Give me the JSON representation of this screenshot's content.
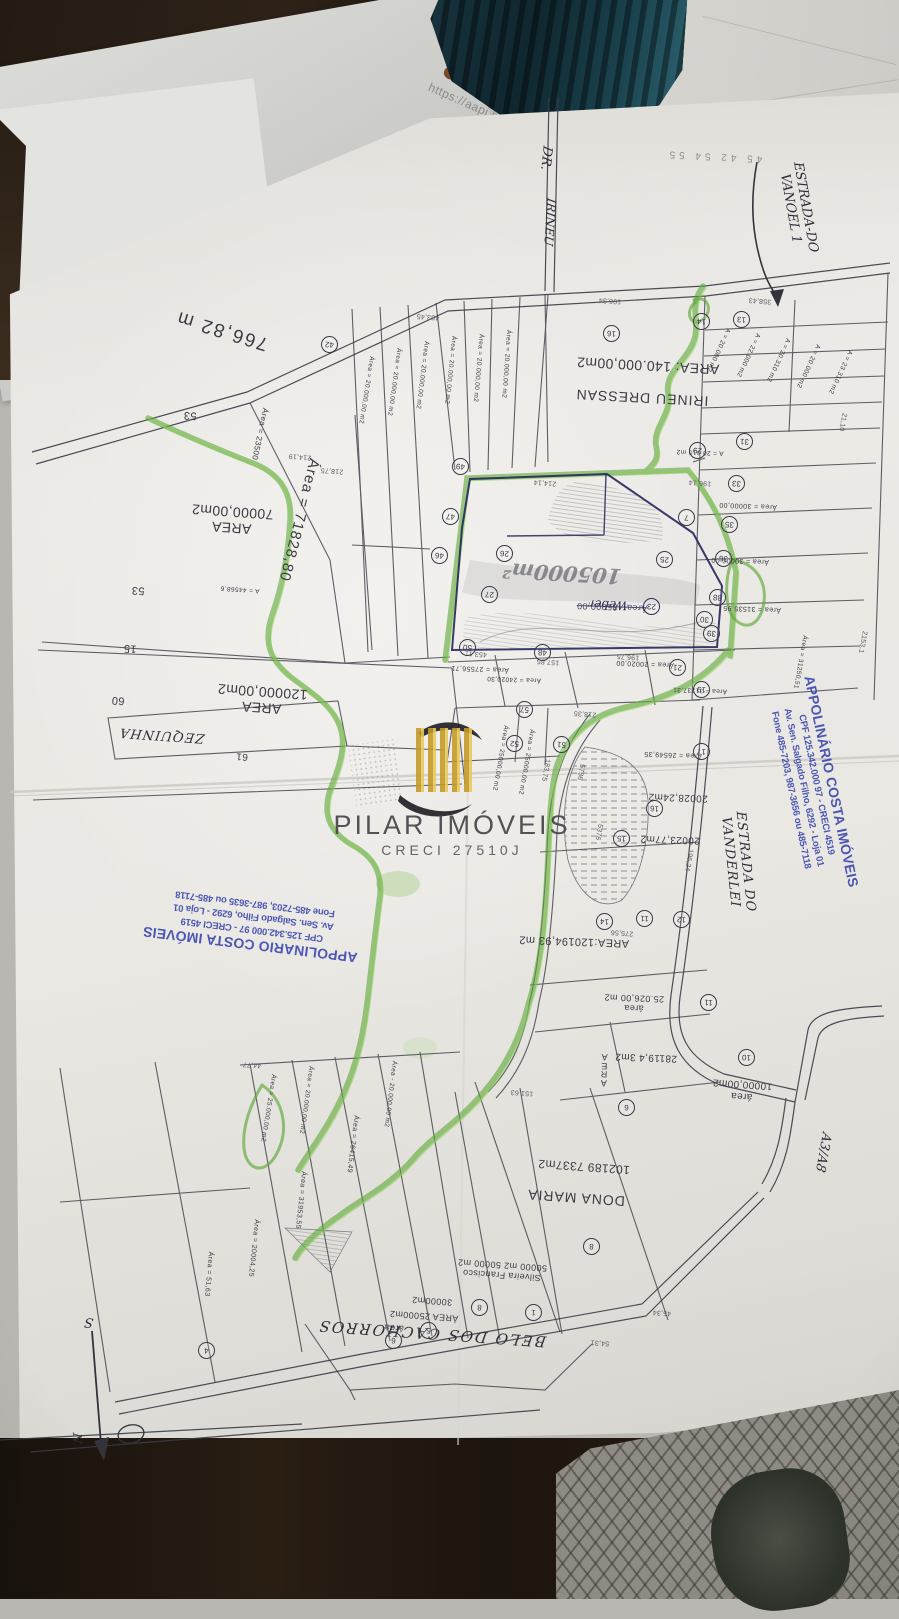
{
  "background": {
    "url_text": "https://aapj.bb.com"
  },
  "watermark": {
    "title": "PILAR IMÓVEIS",
    "creci": "CRECI 27510J"
  },
  "stamp_right": {
    "lines": [
      "APPOLINÁRIO COSTA IMÓVEIS",
      "CPF 125.342.000 97  -  CRECI 4519",
      "Av. Sen. Salgado Filho, 6292 - Loja 01",
      "Fone 485-7203, 987-3656 ou 485-7118"
    ]
  },
  "stamp_left": {
    "lines": [
      "APPOLINARIO COSTA IMÓVEIS",
      "CPF 125.342.000 97  -  CRECI 4519",
      "Av. Sen. Salgado Filho, 6292 - Loja 01",
      "Fone 485-7203, 987-3635 ou 485-7118"
    ]
  },
  "map_labels": [
    {
      "t": "766,82 m",
      "x": 222,
      "y": 330,
      "r": 197,
      "s": 19,
      "ls": 2
    },
    {
      "t": "Área = 71828,80",
      "x": 299,
      "y": 520,
      "r": 104,
      "s": 15,
      "ls": 1
    },
    {
      "t": "Área = 23500",
      "x": 260,
      "y": 434,
      "r": 102,
      "s": 8
    },
    {
      "lines": [
        "AREA",
        "70000,00m2"
      ],
      "x": 232,
      "y": 520,
      "r": 184,
      "s": 14
    },
    {
      "lines": [
        "AREA",
        "120000,00m2"
      ],
      "x": 262,
      "y": 700,
      "r": 184,
      "s": 14
    },
    {
      "t": "AREA: 140.000,00m2",
      "x": 648,
      "y": 366,
      "r": 183,
      "s": 14
    },
    {
      "t": "IRINEU DRESSAN",
      "x": 642,
      "y": 398,
      "r": 183,
      "s": 14,
      "ls": 1
    },
    {
      "t": "AREA:120194,93 m2",
      "x": 574,
      "y": 941,
      "r": 182,
      "s": 11
    },
    {
      "t": "Área = 26549,35",
      "x": 673,
      "y": 754,
      "r": 182,
      "s": 7
    },
    {
      "t": "20028,24m2",
      "x": 678,
      "y": 797,
      "r": 182,
      "s": 10
    },
    {
      "t": "20023,77m2",
      "x": 670,
      "y": 839,
      "r": 182,
      "s": 10
    },
    {
      "lines": [
        "área",
        "25.026,00 m2"
      ],
      "x": 634,
      "y": 1003,
      "r": 182,
      "s": 9
    },
    {
      "t": "28119,4 3m2",
      "x": 646,
      "y": 1057,
      "r": 182,
      "s": 10
    },
    {
      "lines": [
        "A",
        "R",
        "E",
        "A"
      ],
      "x": 604,
      "y": 1070,
      "r": 182,
      "s": 9,
      "cls": "tight"
    },
    {
      "t": "102189 7337m2",
      "x": 584,
      "y": 1166,
      "r": 184,
      "s": 12
    },
    {
      "t": "DONA MARIA",
      "x": 576,
      "y": 1198,
      "r": 184,
      "s": 14,
      "ls": 1
    },
    {
      "lines": [
        "Silveira Francisco",
        "50000 m2  50000 m2"
      ],
      "x": 502,
      "y": 1270,
      "r": 184,
      "s": 9
    },
    {
      "t": "30000m2",
      "x": 432,
      "y": 1301,
      "r": 184,
      "s": 9
    },
    {
      "t": "ÁREA 25000m2",
      "x": 424,
      "y": 1316,
      "r": 184,
      "s": 9
    },
    {
      "t": "área",
      "x": 394,
      "y": 1328,
      "r": 184,
      "s": 9
    },
    {
      "lines": [
        "área",
        "10000,00m2"
      ],
      "x": 742,
      "y": 1090,
      "r": 184,
      "s": 10
    },
    {
      "t": "Área = 20.000,00 m2",
      "x": 366,
      "y": 390,
      "r": 99,
      "s": 6.5
    },
    {
      "t": "Área = 20.000,00 m2",
      "x": 394,
      "y": 382,
      "r": 98,
      "s": 6.5
    },
    {
      "t": "Área = 20.000,00 m2",
      "x": 422,
      "y": 375,
      "r": 97,
      "s": 6.5
    },
    {
      "t": "Área = 20.000,00 m2",
      "x": 450,
      "y": 370,
      "r": 96,
      "s": 6.5
    },
    {
      "t": "Área = 20.000,00 m2",
      "x": 478,
      "y": 368,
      "r": 95,
      "s": 6.5
    },
    {
      "t": "Área = 20.000,00 m2",
      "x": 506,
      "y": 364,
      "r": 94,
      "s": 6.5
    },
    {
      "t": "A = 20.000 m2",
      "x": 718,
      "y": 350,
      "r": 115,
      "s": 6.5
    },
    {
      "t": "A = 22.000 m2",
      "x": 748,
      "y": 355,
      "r": 115,
      "s": 6.5
    },
    {
      "t": "A = 20.310 m2",
      "x": 778,
      "y": 360,
      "r": 115,
      "s": 6.5
    },
    {
      "t": "A = 20.000 m2",
      "x": 808,
      "y": 366,
      "r": 115,
      "s": 6.5
    },
    {
      "t": "A = 23.310 m2",
      "x": 840,
      "y": 372,
      "r": 115,
      "s": 6.5
    },
    {
      "t": "A = 20.010 m2",
      "x": 700,
      "y": 452,
      "r": 182,
      "s": 6.5
    },
    {
      "t": "Área = 30000,00",
      "x": 748,
      "y": 505,
      "r": 182,
      "s": 7
    },
    {
      "t": "Área = 30000,00",
      "x": 740,
      "y": 560,
      "r": 182,
      "s": 7
    },
    {
      "t": "Área = 31535,95",
      "x": 752,
      "y": 608,
      "r": 182,
      "s": 7
    },
    {
      "t": "Área = 31237,31",
      "x": 700,
      "y": 690,
      "r": 182,
      "s": 6.5
    },
    {
      "t": "Área = 31250,51",
      "x": 800,
      "y": 662,
      "r": 100,
      "s": 6.5
    },
    {
      "t": "Área - 85000,00",
      "x": 612,
      "y": 607,
      "r": 182,
      "s": 9,
      "cls": "strike",
      "c": "#4a4a6a"
    },
    {
      "t": "Área = 27556,71",
      "x": 480,
      "y": 668,
      "r": 182,
      "s": 7
    },
    {
      "t": "Área = 20020,00",
      "x": 645,
      "y": 663,
      "r": 182,
      "s": 7
    },
    {
      "t": "Área = 24020,30",
      "x": 514,
      "y": 679,
      "r": 182,
      "s": 6.5
    },
    {
      "t": "Área = 25000,00 m2",
      "x": 500,
      "y": 758,
      "r": 100,
      "s": 6.5
    },
    {
      "t": "Área = 25000,00 m2",
      "x": 526,
      "y": 762,
      "r": 100,
      "s": 6.5
    },
    {
      "t": "A = 44568,6",
      "x": 240,
      "y": 589,
      "r": 184,
      "s": 6.5
    },
    {
      "t": "Área = 25.000,00 m2",
      "x": 268,
      "y": 1108,
      "r": 99,
      "s": 6.5
    },
    {
      "t": "Área = 20.000,00 m2",
      "x": 306,
      "y": 1100,
      "r": 98,
      "s": 6.5
    },
    {
      "t": "Área = 26415,49",
      "x": 352,
      "y": 1144,
      "r": 97,
      "s": 7
    },
    {
      "t": "Área = 31953,55",
      "x": 300,
      "y": 1200,
      "r": 96,
      "s": 7
    },
    {
      "t": "Área = 20004,25",
      "x": 253,
      "y": 1248,
      "r": 96,
      "s": 7
    },
    {
      "t": "Área = 51,63",
      "x": 208,
      "y": 1274,
      "r": 95,
      "s": 7
    },
    {
      "t": "Área - 20.000,00 m2",
      "x": 390,
      "y": 1094,
      "r": 97,
      "s": 6.5
    },
    {
      "t": "60",
      "x": 118,
      "y": 700,
      "r": 184,
      "s": 11
    },
    {
      "t": "15",
      "x": 130,
      "y": 648,
      "r": 184,
      "s": 11
    },
    {
      "t": "61",
      "x": 242,
      "y": 756,
      "r": 184,
      "s": 10
    },
    {
      "t": "53",
      "x": 190,
      "y": 415,
      "r": 184,
      "s": 11
    },
    {
      "t": "53",
      "x": 138,
      "y": 590,
      "r": 184,
      "s": 11
    },
    {
      "t": "45  42  54  55",
      "x": 714,
      "y": 156,
      "r": 183,
      "s": 10,
      "c": "#90908c",
      "ls": 4
    }
  ],
  "hand_labels": [
    {
      "t": "DR.",
      "x": 545,
      "y": 158,
      "r": 96,
      "s": 13
    },
    {
      "t": "IRINEU",
      "x": 549,
      "y": 222,
      "r": 94,
      "s": 12
    },
    {
      "lines": [
        "ESTRADA-DO",
        "VANOEL 1"
      ],
      "x": 797,
      "y": 208,
      "r": 80,
      "s": 13
    },
    {
      "t": "ESTRADA DO VANDERLEI",
      "x": 737,
      "y": 862,
      "r": 84,
      "s": 13,
      "ls": 1
    },
    {
      "t": "A3/A8",
      "x": 822,
      "y": 1152,
      "r": 100,
      "s": 13
    },
    {
      "t": "ZEQUINHA",
      "x": 162,
      "y": 734,
      "r": 184,
      "s": 13,
      "ls": 1
    },
    {
      "t": "BELO DOS CACHORROS",
      "x": 432,
      "y": 1333,
      "r": 184,
      "s": 15,
      "ls": 2
    },
    {
      "t": "105000m²",
      "x": 562,
      "y": 573,
      "r": 183,
      "s": 21,
      "c": "#73737c",
      "cls": "pencil"
    },
    {
      "t": "Weber",
      "x": 608,
      "y": 604,
      "r": 182,
      "s": 12,
      "c": "#2a2a55"
    },
    {
      "t": "S",
      "x": 89,
      "y": 1321,
      "r": 184,
      "s": 13
    },
    {
      "t": "N",
      "x": 76,
      "y": 1438,
      "r": 90,
      "s": 12
    }
  ],
  "circled_numbers": [
    {
      "n": "42",
      "x": 328,
      "y": 343
    },
    {
      "n": "49",
      "x": 459,
      "y": 465
    },
    {
      "n": "47",
      "x": 449,
      "y": 515
    },
    {
      "n": "46",
      "x": 438,
      "y": 554
    },
    {
      "n": "50",
      "x": 466,
      "y": 646
    },
    {
      "n": "48",
      "x": 541,
      "y": 651
    },
    {
      "n": "26",
      "x": 503,
      "y": 552
    },
    {
      "n": "27",
      "x": 488,
      "y": 593
    },
    {
      "n": "25",
      "x": 663,
      "y": 558
    },
    {
      "n": "23",
      "x": 650,
      "y": 605,
      "c": "#2a2a55"
    },
    {
      "n": "29",
      "x": 696,
      "y": 449
    },
    {
      "n": "7",
      "x": 685,
      "y": 516
    },
    {
      "n": "30",
      "x": 703,
      "y": 618
    },
    {
      "n": "21",
      "x": 676,
      "y": 666
    },
    {
      "n": "19",
      "x": 700,
      "y": 688
    },
    {
      "n": "14",
      "x": 700,
      "y": 320
    },
    {
      "n": "13",
      "x": 740,
      "y": 318
    },
    {
      "n": "16",
      "x": 610,
      "y": 332
    },
    {
      "n": "31",
      "x": 743,
      "y": 440
    },
    {
      "n": "33",
      "x": 735,
      "y": 482
    },
    {
      "n": "35",
      "x": 728,
      "y": 523
    },
    {
      "n": "36",
      "x": 722,
      "y": 557
    },
    {
      "n": "38",
      "x": 716,
      "y": 596
    },
    {
      "n": "39",
      "x": 710,
      "y": 632
    },
    {
      "n": "52",
      "x": 513,
      "y": 742
    },
    {
      "n": "51",
      "x": 560,
      "y": 743
    },
    {
      "n": "57",
      "x": 523,
      "y": 708
    },
    {
      "n": "17",
      "x": 700,
      "y": 750
    },
    {
      "n": "16",
      "x": 653,
      "y": 807
    },
    {
      "n": "15",
      "x": 620,
      "y": 837
    },
    {
      "n": "14",
      "x": 603,
      "y": 920
    },
    {
      "n": "11",
      "x": 643,
      "y": 917
    },
    {
      "n": "12",
      "x": 680,
      "y": 918
    },
    {
      "n": "11",
      "x": 707,
      "y": 1001
    },
    {
      "n": "10",
      "x": 745,
      "y": 1056
    },
    {
      "n": "6",
      "x": 625,
      "y": 1106
    },
    {
      "n": "8",
      "x": 590,
      "y": 1245
    },
    {
      "n": "1",
      "x": 532,
      "y": 1311
    },
    {
      "n": "8",
      "x": 478,
      "y": 1306
    },
    {
      "n": "5",
      "x": 427,
      "y": 1329
    },
    {
      "n": "6",
      "x": 392,
      "y": 1339
    },
    {
      "n": "4",
      "x": 205,
      "y": 1349
    }
  ],
  "micro_numbers": [
    {
      "t": "214,19",
      "x": 300,
      "y": 456
    },
    {
      "t": "218,75",
      "x": 332,
      "y": 470
    },
    {
      "t": "453,45",
      "x": 428,
      "y": 316
    },
    {
      "t": "196,34",
      "x": 610,
      "y": 300
    },
    {
      "t": "358,43",
      "x": 760,
      "y": 300
    },
    {
      "t": "214,14",
      "x": 545,
      "y": 482
    },
    {
      "t": "196,14",
      "x": 700,
      "y": 482
    },
    {
      "t": "453,11",
      "x": 476,
      "y": 653
    },
    {
      "t": "157,85",
      "x": 548,
      "y": 661
    },
    {
      "t": "196,75",
      "x": 628,
      "y": 656
    },
    {
      "t": "218,35",
      "x": 585,
      "y": 713
    },
    {
      "t": "275,56",
      "x": 622,
      "y": 932
    },
    {
      "t": "151,63",
      "x": 522,
      "y": 1092
    },
    {
      "t": "54,31",
      "x": 600,
      "y": 1342
    },
    {
      "t": "45,34",
      "x": 662,
      "y": 1312
    },
    {
      "t": "44,77",
      "x": 252,
      "y": 1064
    },
    {
      "t": "5736",
      "x": 580,
      "y": 772,
      "r": 100
    },
    {
      "t": "5376",
      "x": 598,
      "y": 832,
      "r": 100
    },
    {
      "t": "2153,1",
      "x": 862,
      "y": 642,
      "r": 100
    },
    {
      "t": "21,10",
      "x": 842,
      "y": 422,
      "r": 100
    },
    {
      "t": "196,24",
      "x": 688,
      "y": 860,
      "r": 100
    },
    {
      "t": "183,75",
      "x": 545,
      "y": 770,
      "r": 100
    }
  ]
}
